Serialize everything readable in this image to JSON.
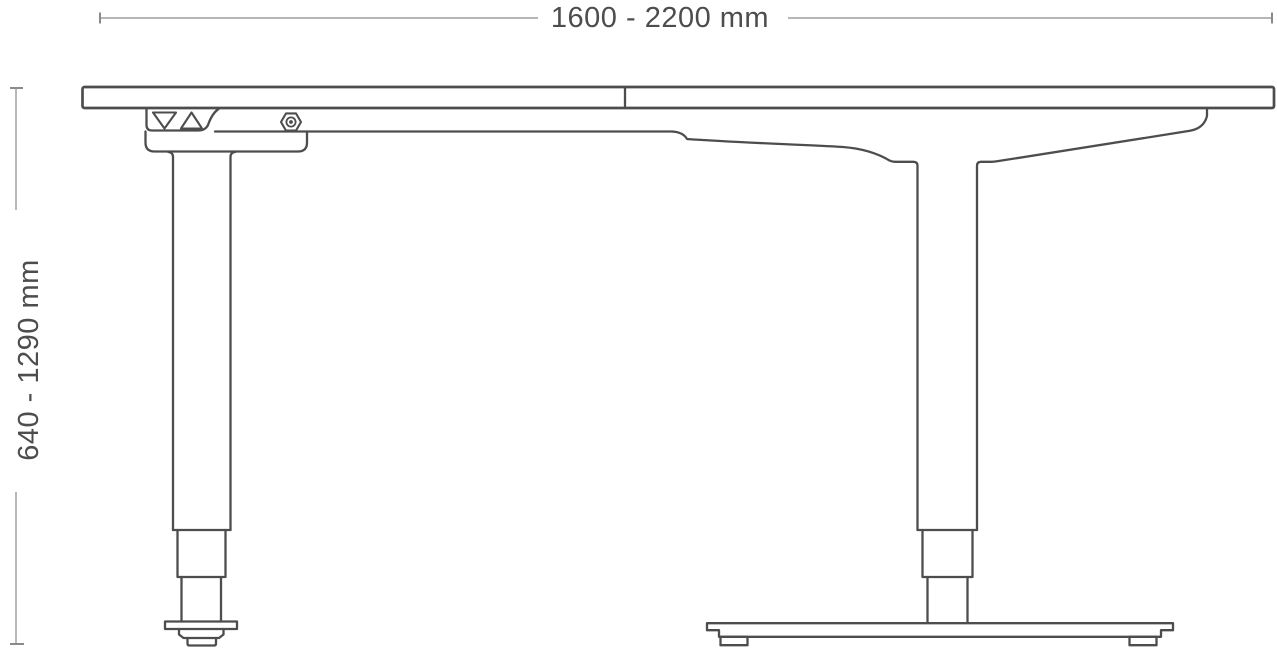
{
  "drawing": {
    "subject": "height-adjustable desk technical drawing",
    "dimensions": {
      "width_label": "1600 - 2200 mm",
      "height_label": "640 - 1290 mm"
    },
    "icons": [
      {
        "name": "down-arrow-icon",
        "glyph": "outlined triangle pointing down"
      },
      {
        "name": "up-arrow-icon",
        "glyph": "outlined triangle pointing up"
      },
      {
        "name": "hex-bolt-icon",
        "glyph": "hexagon nut with center dot"
      }
    ],
    "colors": {
      "outline": "#4d4d4d",
      "dimension_line": "#ababab",
      "dimension_tick": "#8a8a8a",
      "text": "#4d4d4d",
      "background": "#ffffff"
    }
  }
}
